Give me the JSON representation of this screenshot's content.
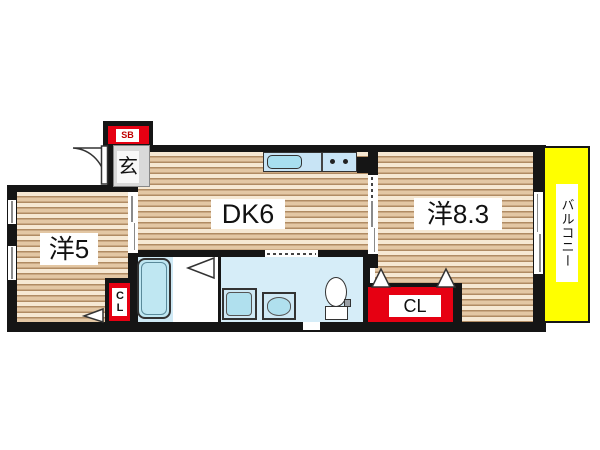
{
  "rooms": {
    "dining_kitchen": {
      "label": "DK6"
    },
    "western_room_8_3": {
      "label": "洋8.3"
    },
    "western_room_5": {
      "label": "洋5"
    },
    "entrance": {
      "label": "玄"
    },
    "balcony": {
      "label": "バルコニー"
    }
  },
  "storage": {
    "shoe_box": {
      "label": "SB"
    },
    "closet_west8": {
      "label": "CL"
    },
    "closet_west5": {
      "label": "CL"
    }
  },
  "colors": {
    "wall_black": "#151515",
    "floor_cream": "#f6e8d3",
    "floor_tan": "#e3c7a4",
    "floor_line": "#b08b63",
    "balcony_yellow": "#ffff00",
    "storage_red": "#e60012",
    "water_area_blue": "#d6edf8",
    "fixture_fill_blue": "#b0e0ee",
    "entrance_gray": "#d9d9d9"
  }
}
